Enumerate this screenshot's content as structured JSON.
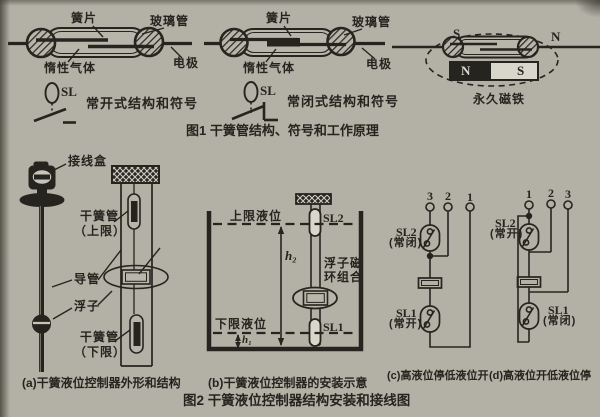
{
  "colors": {
    "paper": "#b3b0a5",
    "ink": "#26241f",
    "light": "#d9d7cb"
  },
  "fig1": {
    "caption": "图1  干簧管结构、符号和工作原理",
    "reed_no": {
      "reed": "簧片",
      "glass_tube": "玻璃管",
      "inert_gas": "惰性气体",
      "electrode": "电极",
      "symbol": "SL",
      "symbol_caption": "常开式结构和符号"
    },
    "reed_nc": {
      "reed": "簧片",
      "glass_tube": "玻璃管",
      "inert_gas": "惰性气体",
      "electrode": "电极",
      "symbol": "SL",
      "symbol_caption": "常闭式结构和符号"
    },
    "magnet": {
      "s_near": "S",
      "n_near": "N",
      "pole_n": "N",
      "pole_s": "S",
      "label": "永久磁铁"
    }
  },
  "fig2": {
    "caption": "图2   干簧液位控制器结构安装和接线图",
    "a": {
      "junction_box": "接线盒",
      "reed_upper_1": "干簧管",
      "reed_upper_2": "（上限）",
      "magnet_ring": "磁环",
      "guide_tube": "导管",
      "float": "浮子",
      "reed_lower_1": "干簧管",
      "reed_lower_2": "（下限）",
      "caption": "(a)干簧液位控制器外形和结构"
    },
    "b": {
      "upper_level": "上限液位",
      "sl2": "SL2",
      "h2": "h₂",
      "float_ring_1": "浮子磁",
      "float_ring_2": "环组合",
      "lower_level": "下限液位",
      "sl1": "SL1",
      "h1": "h₁",
      "caption": "(b)干簧液位控制器的安装示意"
    },
    "c": {
      "terminals": [
        "3",
        "2",
        "1"
      ],
      "sl2": "SL2",
      "sl2_state": "(常闭)",
      "sl1": "SL1",
      "sl1_state": "(常开)",
      "caption": "(c)高液位停低液位开"
    },
    "d": {
      "terminals": [
        "1",
        "2",
        "3"
      ],
      "sl2": "SL2",
      "sl2_state": "(常开)",
      "sl1": "SL1",
      "sl1_state": "(常闭)",
      "caption": "(d)高液位开低液位停"
    }
  }
}
